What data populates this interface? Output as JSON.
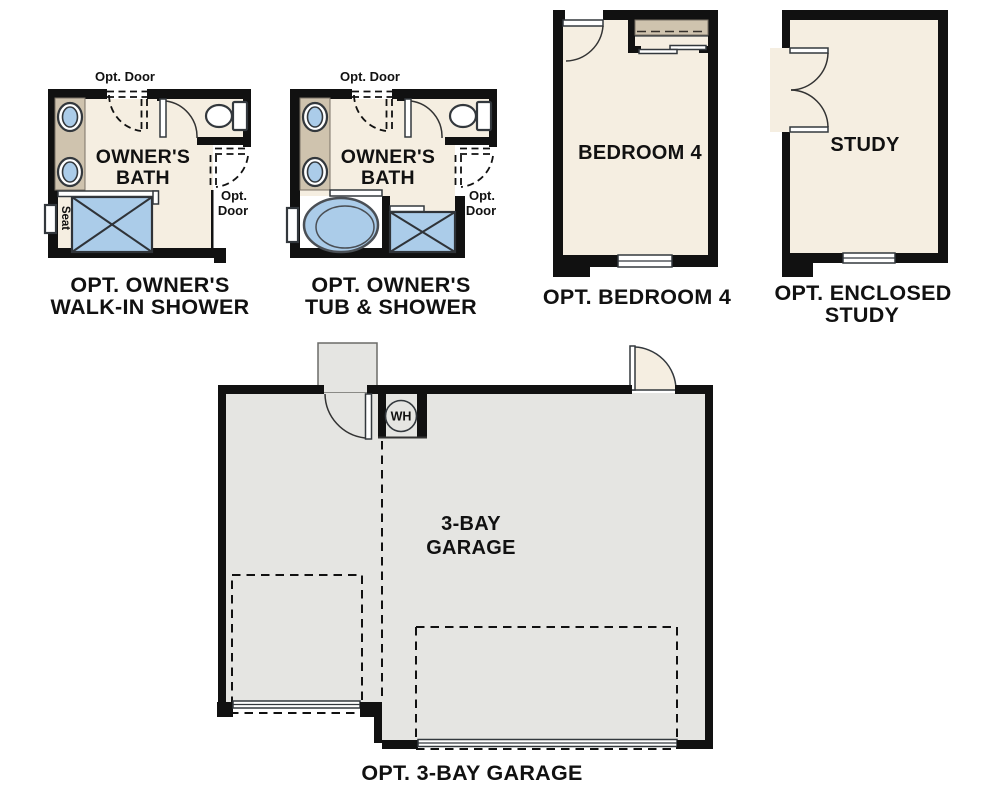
{
  "colors": {
    "wall": "#111111",
    "room_fill": "#f5eee1",
    "garage_fill": "#e5e5e2",
    "counter_fill": "#cfc3ae",
    "fixture_blue": "#abcce9",
    "line": "#333333",
    "text_color": "#111111",
    "background": "#ffffff"
  },
  "plans": {
    "walkin_shower": {
      "opt_door_top_label": "Opt. Door",
      "room_label_line1": "OWNER'S",
      "room_label_line2": "BATH",
      "opt_door_right_line1": "Opt.",
      "opt_door_right_line2": "Door",
      "seat_label": "Seat",
      "caption_line1": "OPT. OWNER'S",
      "caption_line2": "WALK-IN SHOWER"
    },
    "tub_shower": {
      "opt_door_top_label": "Opt. Door",
      "room_label_line1": "OWNER'S",
      "room_label_line2": "BATH",
      "opt_door_right_line1": "Opt.",
      "opt_door_right_line2": "Door",
      "caption_line1": "OPT. OWNER'S",
      "caption_line2": "TUB & SHOWER"
    },
    "bedroom4": {
      "room_label": "BEDROOM 4",
      "caption": "OPT. BEDROOM 4"
    },
    "study": {
      "room_label": "STUDY",
      "caption_line1": "OPT. ENCLOSED",
      "caption_line2": "STUDY"
    },
    "garage": {
      "water_heater_label": "WH",
      "room_label_line1": "3-BAY",
      "room_label_line2": "GARAGE",
      "caption": "OPT. 3-BAY GARAGE"
    }
  }
}
